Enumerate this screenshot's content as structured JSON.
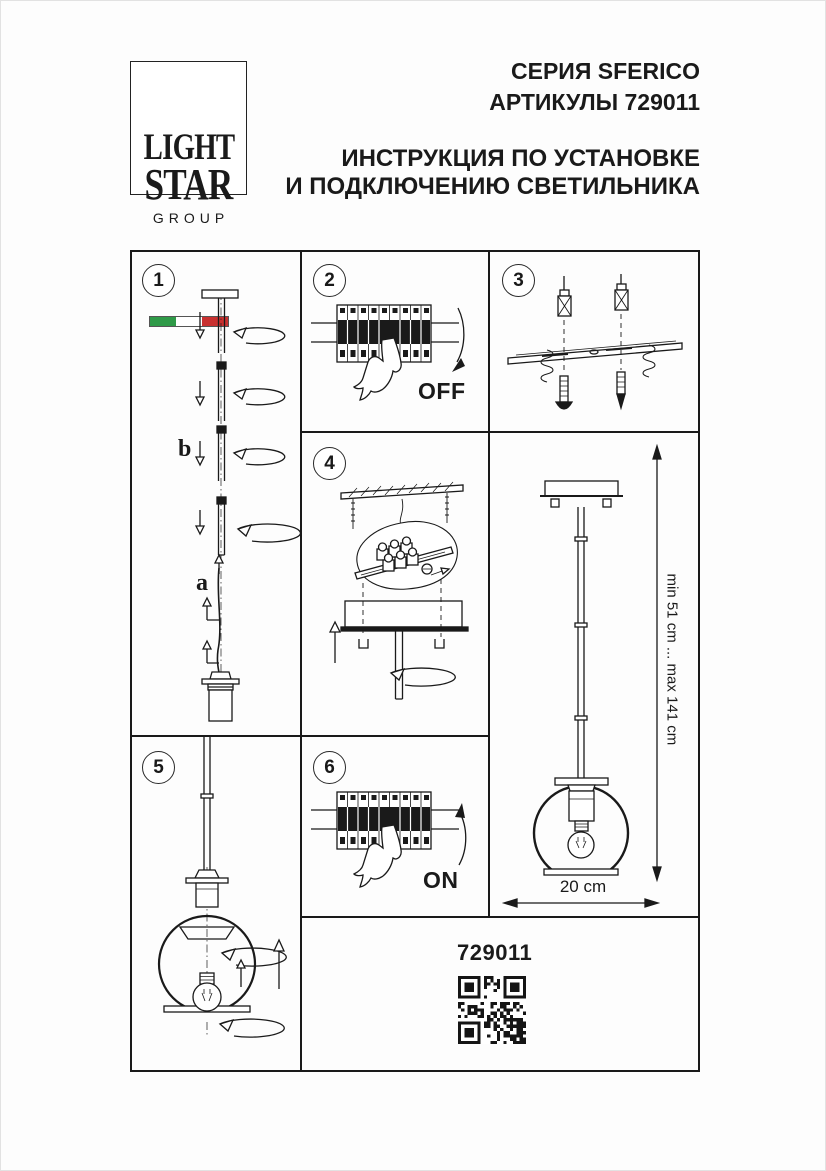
{
  "header": {
    "logo": {
      "line1": "LIGHT",
      "line2": "STAR",
      "line3": "GROUP"
    },
    "series": "СЕРИЯ SFERICO",
    "article": "АРТИКУЛЫ 729011",
    "title_line1": "ИНСТРУКЦИЯ ПО УСТАНОВКЕ",
    "title_line2": "И ПОДКЛЮЧЕНИЮ СВЕТИЛЬНИКА"
  },
  "colors": {
    "ink": "#1a1a1a",
    "flag_green": "#2f9a48",
    "flag_white": "#ffffff",
    "flag_red": "#c8302f"
  },
  "steps": {
    "s1": {
      "number": "1",
      "label_b": "b",
      "label_a": "a"
    },
    "s2": {
      "number": "2",
      "state": "OFF"
    },
    "s3": {
      "number": "3"
    },
    "s4": {
      "number": "4"
    },
    "s5": {
      "number": "5"
    },
    "s6": {
      "number": "6",
      "state": "ON"
    }
  },
  "overview": {
    "height_range": "min 51 cm ... max 141 cm",
    "diameter": "20 cm"
  },
  "footer": {
    "article": "729011",
    "qr": "qr-code"
  }
}
